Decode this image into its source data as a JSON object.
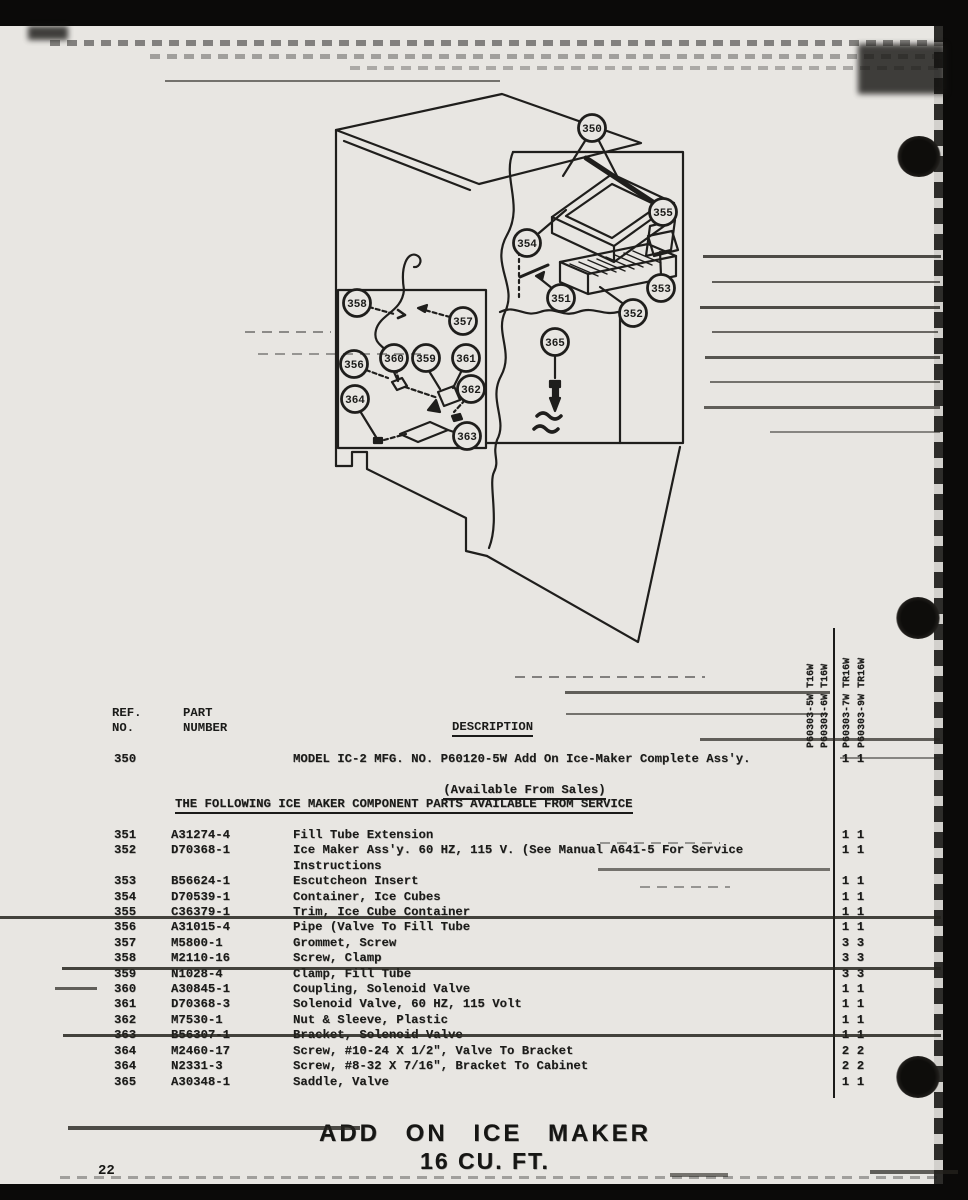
{
  "colors": {
    "paper": "#e8e6e2",
    "ink": "#1b1b19"
  },
  "page": {
    "number": "22",
    "footer_title": "ADD ON ICE MAKER",
    "footer_subtitle": "16 CU. FT."
  },
  "table": {
    "header": {
      "ref_l1": "REF.",
      "ref_l2": "NO.",
      "part_l1": "PART",
      "part_l2": "NUMBER",
      "description": "DESCRIPTION"
    },
    "model_columns": [
      "P60303-5W T16W",
      "P60303-6W T16W",
      "P60303-7W TR16W",
      "P60303-9W TR16W"
    ],
    "intro_row": {
      "ref": "350",
      "part": "",
      "desc": "MODEL IC-2 MFG. NO. P60120-5W Add On Ice-Maker Complete Ass'y.",
      "desc2": "(Available From Sales)",
      "qty1": "1",
      "qty2": "1"
    },
    "section_heading": "THE FOLLOWING ICE MAKER COMPONENT PARTS AVAILABLE FROM SERVICE",
    "rows": [
      {
        "ref": "351",
        "part": "A31274-4",
        "desc": "Fill Tube Extension",
        "qty1": "1",
        "qty2": "1"
      },
      {
        "ref": "352",
        "part": "D70368-1",
        "desc": "Ice Maker Ass'y. 60 HZ, 115 V. (See Manual A641-5 For Service",
        "desc2": "Instructions",
        "qty1": "1",
        "qty2": "1"
      },
      {
        "ref": "353",
        "part": "B56624-1",
        "desc": "Escutcheon Insert",
        "qty1": "1",
        "qty2": "1"
      },
      {
        "ref": "354",
        "part": "D70539-1",
        "desc": "Container, Ice Cubes",
        "qty1": "1",
        "qty2": "1"
      },
      {
        "ref": "355",
        "part": "C36379-1",
        "desc": "Trim, Ice Cube Container",
        "qty1": "1",
        "qty2": "1"
      },
      {
        "ref": "356",
        "part": "A31015-4",
        "desc": "Pipe (Valve To Fill Tube",
        "qty1": "1",
        "qty2": "1"
      },
      {
        "ref": "357",
        "part": "M5800-1",
        "desc": "Grommet, Screw",
        "qty1": "3",
        "qty2": "3"
      },
      {
        "ref": "358",
        "part": "M2110-16",
        "desc": "Screw, Clamp",
        "qty1": "3",
        "qty2": "3"
      },
      {
        "ref": "359",
        "part": "N1028-4",
        "desc": "Clamp, Fill Tube",
        "qty1": "3",
        "qty2": "3"
      },
      {
        "ref": "360",
        "part": "A30845-1",
        "desc": "Coupling, Solenoid Valve",
        "qty1": "1",
        "qty2": "1"
      },
      {
        "ref": "361",
        "part": "D70368-3",
        "desc": "Solenoid Valve, 60 HZ, 115 Volt",
        "qty1": "1",
        "qty2": "1"
      },
      {
        "ref": "362",
        "part": "M7530-1",
        "desc": "Nut & Sleeve, Plastic",
        "qty1": "1",
        "qty2": "1"
      },
      {
        "ref": "363",
        "part": "B56307-1",
        "desc": "Bracket, Solenoid Valve",
        "qty1": "1",
        "qty2": "1"
      },
      {
        "ref": "364",
        "part": "M2460-17",
        "desc": "Screw, #10-24 X 1/2\", Valve To Bracket",
        "qty1": "2",
        "qty2": "2"
      },
      {
        "ref": "364",
        "part": "N2331-3",
        "desc": "Screw, #8-32 X 7/16\", Bracket To Cabinet",
        "qty1": "2",
        "qty2": "2"
      },
      {
        "ref": "365",
        "part": "A30348-1",
        "desc": "Saddle, Valve",
        "qty1": "1",
        "qty2": "1"
      }
    ]
  },
  "diagram": {
    "callouts": [
      {
        "label": "350",
        "x": 592,
        "y": 128
      },
      {
        "label": "354",
        "x": 527,
        "y": 243
      },
      {
        "label": "355",
        "x": 663,
        "y": 212
      },
      {
        "label": "353",
        "x": 661,
        "y": 288
      },
      {
        "label": "351",
        "x": 561,
        "y": 298
      },
      {
        "label": "352",
        "x": 633,
        "y": 313
      },
      {
        "label": "365",
        "x": 555,
        "y": 342
      },
      {
        "label": "358",
        "x": 357,
        "y": 303
      },
      {
        "label": "357",
        "x": 463,
        "y": 321
      },
      {
        "label": "356",
        "x": 354,
        "y": 364
      },
      {
        "label": "364",
        "x": 355,
        "y": 399
      },
      {
        "label": "360",
        "x": 394,
        "y": 358
      },
      {
        "label": "359",
        "x": 426,
        "y": 358
      },
      {
        "label": "361",
        "x": 466,
        "y": 358
      },
      {
        "label": "362",
        "x": 471,
        "y": 389
      },
      {
        "label": "363",
        "x": 467,
        "y": 436
      }
    ]
  }
}
